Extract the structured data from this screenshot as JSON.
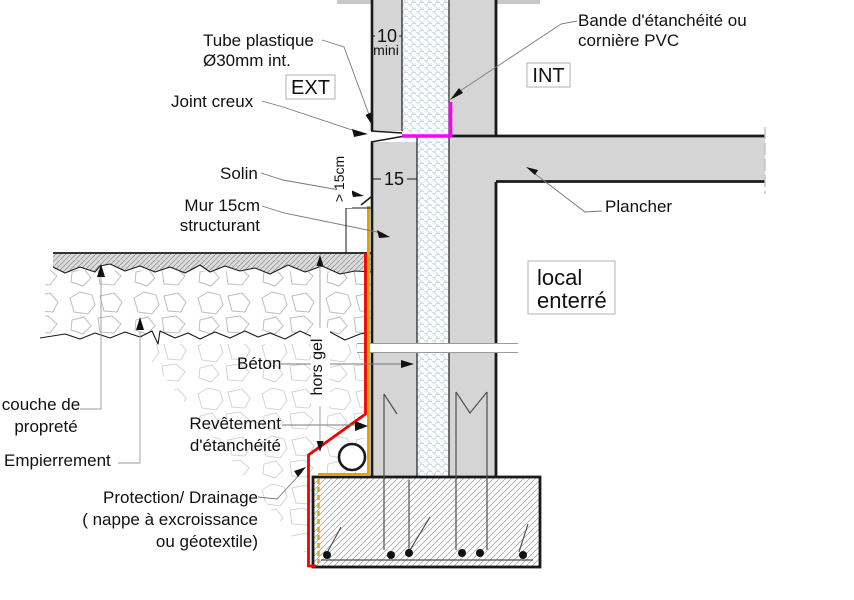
{
  "drawing": {
    "zone_markers": {
      "exterior": "EXT",
      "interior": "INT",
      "room": {
        "line1": "local",
        "line2": "enterré"
      }
    },
    "annotations": {
      "tube_plastique": {
        "line1": "Tube plastique",
        "line2": "Ø30mm int."
      },
      "joint_creux": "Joint creux",
      "bande_etancheite": {
        "line1": "Bande d'étanchéité ou",
        "line2": "cornière PVC"
      },
      "solin": "Solin",
      "mur_structurant": {
        "line1": "Mur 15cm",
        "line2": "structurant"
      },
      "plancher": "Plancher",
      "beton": "Béton",
      "hors_gel": "hors gel",
      "couche_proprete": {
        "line1": "couche de",
        "line2": "propreté"
      },
      "empierrement": "Empierrement",
      "revetement_etancheite": {
        "line1": "Revêtement",
        "line2": "d'étanchéité"
      },
      "protection_drainage": {
        "line1": "Protection/ Drainage",
        "line2": "( nappe à excroissance",
        "line3": "ou géotextile)"
      }
    },
    "dimensions": {
      "facade_thickness": "10",
      "facade_thickness_note": "mini",
      "wall_thickness": "15",
      "solin_height_min": "> 15cm"
    },
    "colors": {
      "waterproof_band": "#fb00fb",
      "waterproof_coating": "#e2a400",
      "protection_drainage": "#f40000",
      "concrete_fill": "#d5d5d5",
      "insulation_tint": "#f2f7fa"
    }
  }
}
